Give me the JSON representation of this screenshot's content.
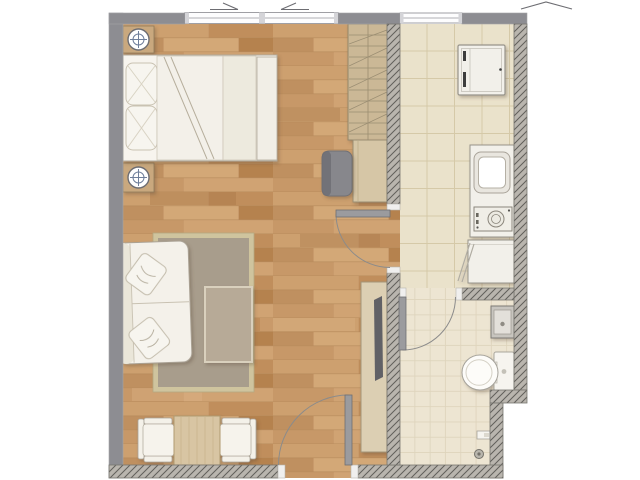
{
  "document": {
    "type": "apartment-floor-plan",
    "view": "top-down 3d-rendered",
    "text_labels": []
  },
  "plan": {
    "rooms": [
      {
        "name": "living-bedroom",
        "floor": "hardwood-planks",
        "furniture": [
          "double-bed",
          "bed-pillows",
          "nightstand-top",
          "table-lamp-top",
          "nightstand-bottom",
          "table-lamp-bottom",
          "wardrobe",
          "dresser-desk",
          "desk-chair",
          "tv-sideboard",
          "tv",
          "sofa",
          "sofa-pillows",
          "area-rug",
          "coffee-table",
          "dining-table",
          "dining-chair-left",
          "dining-chair-right"
        ]
      },
      {
        "name": "kitchen",
        "floor": "large-beige-tiles",
        "furniture": [
          "refrigerator",
          "kitchen-counter",
          "sink",
          "cooktop",
          "base-cabinet"
        ]
      },
      {
        "name": "bathroom",
        "floor": "small-beige-tiles",
        "furniture": [
          "washbasin",
          "toilet",
          "paper-holder",
          "floor-drain"
        ]
      }
    ],
    "openings": {
      "windows": [
        {
          "name": "bedroom-window",
          "panes": 2
        },
        {
          "name": "kitchen-window",
          "panes": 1
        }
      ],
      "doors": [
        {
          "name": "entry-door",
          "location": "bottom-wall",
          "swing": "into-living-room"
        },
        {
          "name": "living-to-kitchen-door",
          "location": "middle-wall",
          "swing": "into-living-room"
        },
        {
          "name": "bathroom-door",
          "location": "bathroom-top-wall",
          "swing": "into-bathroom"
        }
      ]
    }
  },
  "palette": {
    "outside": "#ffffff",
    "wall_solid": "#8d8d92",
    "wall_hatch_bg": "#b9b5ae",
    "wall_hatch_line": "#615f5b",
    "wall_outline": "#77756f",
    "frame_cap": "#f0efee",
    "door_leaf": "#9b9b9e",
    "arc": "#8b8b8b",
    "window_fill": "#fdfdfe",
    "window_frame": "#95959b",
    "window_post": "#d4d4d8",
    "mark": "#6d6d72",
    "wood_base": "#c89a6b",
    "wood_p1": "#cda06f",
    "wood_p2": "#c08e5c",
    "wood_p3": "#d3a877",
    "wood_p4": "#b5824e",
    "wood_p5": "#c79868",
    "wood_p6": "#d0a373",
    "wood_p7": "#bf9060",
    "tile_k": "#eae2cb",
    "tile_k_line": "#d5c9a8",
    "tile_b": "#ede5d2",
    "tile_b_line": "#ded4bc",
    "rug_border": "#cfc49e",
    "rug_fill": "#a89d8c",
    "coffee_table": "#b7aa97",
    "white_furn": "#f4f1ea",
    "white_furn_soft": "#eae6d9",
    "furn_line": "#a9a399",
    "cushion_line": "#c8c1b1",
    "runner": "#edeade",
    "tan_wood": "#cbb896",
    "tan_wood_line": "#93866a",
    "desk": "#d6c6a6",
    "console": "#dccfb3",
    "nightstand": "#c9a87e",
    "nightstand_line": "#8f7a5a",
    "lamp_ring": "#6f7f9b",
    "chair_gray": "#87878c",
    "chair_gray_dark": "#6f6f74",
    "tv": "#616166",
    "dining_wood": "#d8c5a3",
    "dining_grain": "#c2a87e",
    "appliance": "#f2f0ea",
    "appliance_line": "#97938a",
    "appliance_dark": "#3c3c3e",
    "sink_rim": "#e9e6df",
    "sink_inner": "#ffffff",
    "steel": "#c8c5bf",
    "steel_dark": "#7d7a74",
    "steel_inner": "#e3e0da",
    "drain": "#8f8c84"
  }
}
